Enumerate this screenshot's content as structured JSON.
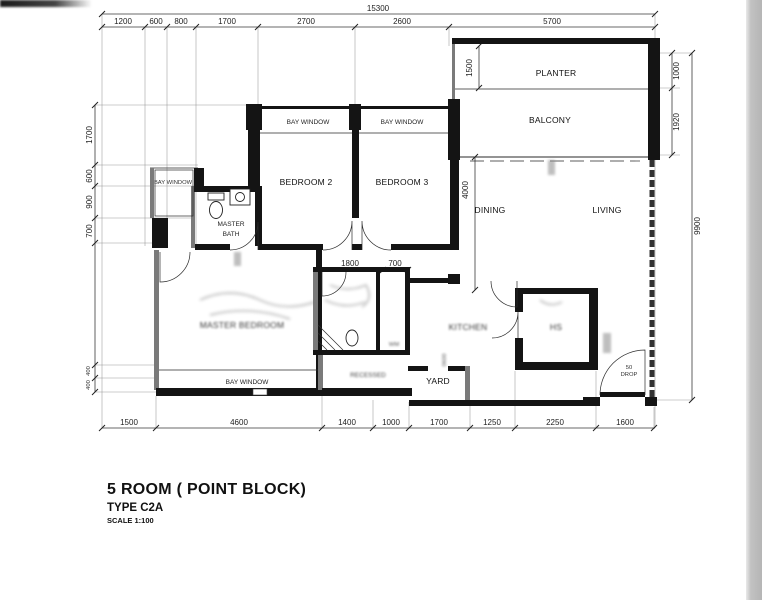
{
  "title": {
    "line1": "5 ROOM ( POINT BLOCK)",
    "line2": "TYPE C2A",
    "line3": "SCALE 1:100"
  },
  "rooms": {
    "planter": "PLANTER",
    "balcony": "BALCONY",
    "living": "LIVING",
    "dining": "DINING",
    "bedroom2": "BEDROOM 2",
    "bedroom3": "BEDROOM 3",
    "bay_window_bd2": "BAY WINDOW",
    "bay_window_bd3": "BAY WINDOW",
    "bay_window_left": "BAY WINDOW",
    "bay_window_master": "BAY WINDOW",
    "master_bath_line1": "MASTER",
    "master_bath_line2": "BATH",
    "master_bedroom": "MASTER BEDROOM",
    "kitchen": "KITCHEN",
    "hs": "HS",
    "wm": "WM",
    "recessed": "RECESSED",
    "yard": "YARD",
    "drop_line1": "50",
    "drop_line2": "DROP",
    "yard_tag": "0600"
  },
  "dims": {
    "overall_top": "15300",
    "top": [
      "1200",
      "600",
      "800",
      "1700",
      "2700",
      "2600",
      "5700"
    ],
    "bottom": [
      "1500",
      "4600",
      "1400",
      "1000",
      "1700",
      "1250",
      "2250",
      "1600"
    ],
    "left": [
      "1700",
      "600",
      "900",
      "700",
      "400",
      "400"
    ],
    "right": [
      "1000",
      "1920"
    ],
    "right_overall": "9900",
    "planter_depth": "1500",
    "dining_depth": "4000",
    "bath_width": "1800",
    "bath_adj": "700"
  }
}
